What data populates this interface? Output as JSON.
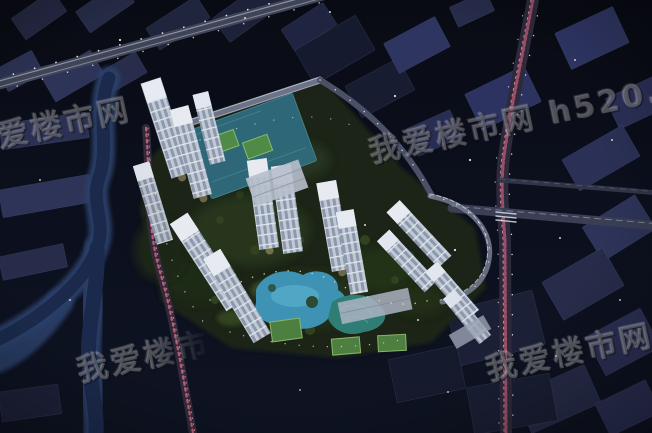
{
  "scene": {
    "type": "night-aerial-render",
    "description": "Night aerial rendering of a riverside residential tower complex with landscaped courtyard, swimming pools, sport courts and surrounding lit city roads",
    "watermarks": {
      "full_text": "我爱楼市网 h520.cn",
      "top_left": "我爱楼市网",
      "top_right": "我爱楼市网 h520.cn",
      "bottom_left": "我爱楼市网",
      "bottom_right": "我爱楼市网 h520.cn"
    },
    "palette": {
      "background": "#0b0e1a",
      "rooftops": "#2b3154",
      "river": "#24365c",
      "towers": "#c6cedb",
      "pool": "#3e93b4",
      "courts": "#4d7f40",
      "tail_lights": "#c96a7e",
      "street_lights": "#ffffff",
      "path_lights": "#ffd9a0"
    }
  }
}
